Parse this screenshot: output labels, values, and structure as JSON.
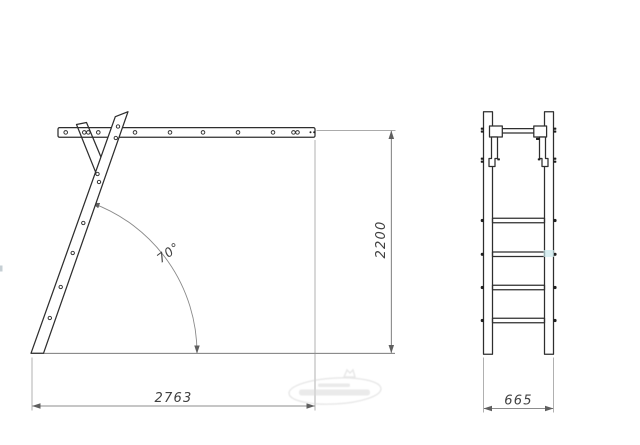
{
  "drawing": {
    "type": "technical-drawing-ladder-two-views",
    "dimensions": {
      "overall_width": "2763",
      "overall_height": "2200",
      "side_width": "665",
      "incline_angle": "70°"
    },
    "colors": {
      "background": "#ffffff",
      "part_outline": "#2e2e2e",
      "dimension_line": "#666666",
      "extension_line": "#8f8f8f",
      "dimension_text": "#414141",
      "bolt_dot": "#1f1f1f",
      "highlight_artifact": "#c9e8ec",
      "watermark": "#d6d6d6"
    }
  }
}
